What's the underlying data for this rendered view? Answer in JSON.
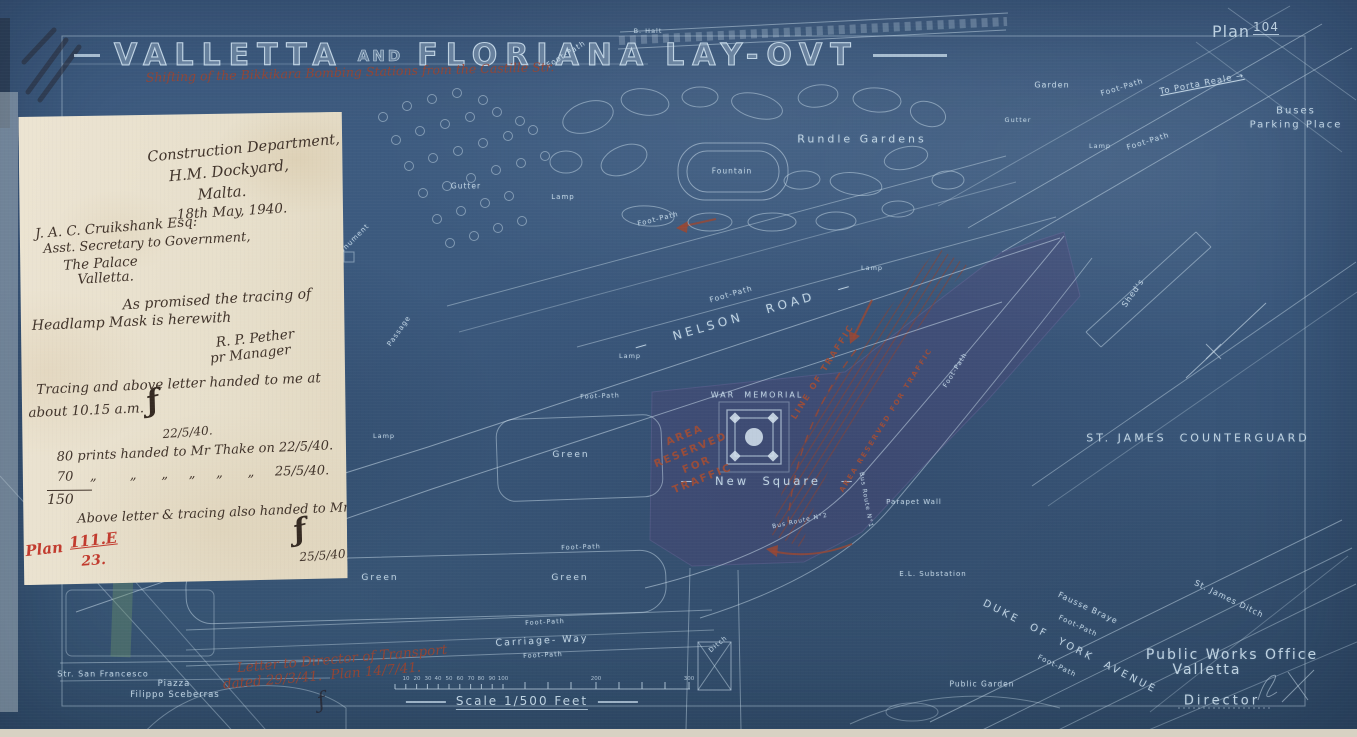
{
  "title": {
    "w1": "VALLETTA",
    "and": "AND",
    "w2": "FLORIANA",
    "w3": "LAY-OVT"
  },
  "plan_ref": {
    "prefix": "Plan",
    "number": "104"
  },
  "scale": {
    "label": "Scale 1/500 Feet",
    "ticks": [
      {
        "t": "10",
        "x": 406
      },
      {
        "t": "20",
        "x": 417
      },
      {
        "t": "30",
        "x": 428
      },
      {
        "t": "40",
        "x": 438
      },
      {
        "t": "50",
        "x": 449
      },
      {
        "t": "60",
        "x": 460
      },
      {
        "t": "70",
        "x": 471
      },
      {
        "t": "80",
        "x": 481
      },
      {
        "t": "90",
        "x": 492
      },
      {
        "t": "100",
        "x": 503
      },
      {
        "t": "200",
        "x": 596
      },
      {
        "t": "300",
        "x": 689
      }
    ]
  },
  "colors": {
    "blueprint": "#3b597d",
    "line": "#c6d9e7",
    "red_note": "#9c432e",
    "paper": "#e7dfcb",
    "ink": "#40332a",
    "red_ink": "#c23b2e"
  },
  "letter": {
    "lines": [
      {
        "t": "Construction Department,",
        "x": 225,
        "y": 36,
        "r": -5,
        "s": 14.5,
        "a": "c"
      },
      {
        "t": "H.M. Dockyard,",
        "x": 210,
        "y": 58,
        "r": -5,
        "s": 15,
        "a": "c"
      },
      {
        "t": "Malta.",
        "x": 203,
        "y": 80,
        "r": -4,
        "s": 15,
        "a": "c"
      },
      {
        "t": "18th May, 1940.",
        "x": 213,
        "y": 99,
        "r": -3,
        "s": 13.5,
        "a": "c"
      },
      {
        "t": "J. A. C. Cruikshank Esq:",
        "x": 16,
        "y": 112,
        "r": -4,
        "s": 13.5
      },
      {
        "t": "Asst. Secretary to Government,",
        "x": 24,
        "y": 128,
        "r": -3,
        "s": 13
      },
      {
        "t": "The Palace",
        "x": 44,
        "y": 144,
        "r": -3,
        "s": 13.5
      },
      {
        "t": "Valletta.",
        "x": 58,
        "y": 158,
        "r": -3,
        "s": 13.5
      },
      {
        "t": "As promised the tracing of",
        "x": 103,
        "y": 184,
        "r": -3,
        "s": 14
      },
      {
        "t": "Headlamp Mask is herewith",
        "x": 12,
        "y": 204,
        "r": -2,
        "s": 14
      },
      {
        "t": "R. P. Pether",
        "x": 196,
        "y": 222,
        "r": -6,
        "s": 13.5
      },
      {
        "t": "pr Manager",
        "x": 190,
        "y": 238,
        "r": -6,
        "s": 13.5
      },
      {
        "t": "Tracing and above letter handed to me at",
        "x": 16,
        "y": 268,
        "r": -2,
        "s": 13.5
      },
      {
        "t": "about 10.15 a.m.",
        "x": 8,
        "y": 291,
        "r": -2,
        "s": 13.5
      },
      {
        "t": "ƒ",
        "x": 126,
        "y": 272,
        "r": -12,
        "s": 30,
        "cls": "mono"
      },
      {
        "t": "22/5/40.",
        "x": 142,
        "y": 314,
        "r": -4,
        "s": 12
      },
      {
        "t": "80 prints handed to Mr Thake on 22/5/40.",
        "x": 36,
        "y": 336,
        "r": -2,
        "s": 13
      },
      {
        "t": "70    „        „      „     „     „      „     25/5/40.",
        "x": 36,
        "y": 356,
        "r": -1,
        "s": 13
      },
      {
        "t": "150",
        "x": 26,
        "y": 376,
        "r": 0,
        "s": 14,
        "cls": "sum"
      },
      {
        "t": "Above letter & tracing also handed to Mr Thake",
        "x": 56,
        "y": 398,
        "r": -2,
        "s": 13
      },
      {
        "t": "ƒ",
        "x": 272,
        "y": 402,
        "r": -12,
        "s": 30,
        "cls": "mono"
      },
      {
        "t": "25/5/40.",
        "x": 278,
        "y": 438,
        "r": -4,
        "s": 12
      },
      {
        "t": "Plan",
        "x": 4,
        "y": 428,
        "r": -6,
        "s": 15,
        "cls": "redink"
      },
      {
        "t": "111.E",
        "x": 48,
        "y": 420,
        "r": -6,
        "s": 15,
        "cls": "redink",
        "u": true
      },
      {
        "t": "23.",
        "x": 60,
        "y": 440,
        "r": -4,
        "s": 14,
        "cls": "redink"
      }
    ]
  },
  "map_labels": [
    {
      "t": "Foot-Path",
      "x": 566,
      "y": 54,
      "r": -32,
      "s": 7.5
    },
    {
      "t": "B. Halt",
      "x": 648,
      "y": 31,
      "r": 0,
      "s": 6.5
    },
    {
      "t": "Foot-Path",
      "x": 1122,
      "y": 87,
      "r": -17,
      "s": 7.5
    },
    {
      "t": "Foot-Path",
      "x": 1148,
      "y": 141,
      "r": -17,
      "s": 7.5
    },
    {
      "t": "Garden",
      "x": 1052,
      "y": 85,
      "r": 0,
      "s": 8
    },
    {
      "t": "To Porta Reale →",
      "x": 1202,
      "y": 84,
      "r": -11,
      "s": 8.5,
      "u": true
    },
    {
      "t": "Buses",
      "x": 1296,
      "y": 111,
      "r": 0,
      "s": 10,
      "ls": 2
    },
    {
      "t": "Parking Place",
      "x": 1296,
      "y": 125,
      "r": 0,
      "s": 10,
      "ls": 2
    },
    {
      "t": "Rundle Gardens",
      "x": 862,
      "y": 139,
      "r": 0,
      "s": 11,
      "ls": 3
    },
    {
      "t": "Fountain",
      "x": 732,
      "y": 171,
      "r": 0,
      "s": 7.5
    },
    {
      "t": "Gutter",
      "x": 466,
      "y": 186,
      "r": 0,
      "s": 7.5
    },
    {
      "t": "Gutter",
      "x": 1018,
      "y": 120,
      "r": 0,
      "s": 6.5
    },
    {
      "t": "Lamp",
      "x": 563,
      "y": 197,
      "r": 0,
      "s": 7
    },
    {
      "t": "Lamp",
      "x": 1100,
      "y": 146,
      "r": 0,
      "s": 6.5
    },
    {
      "t": "Monument",
      "x": 352,
      "y": 241,
      "r": -45,
      "s": 7
    },
    {
      "t": "Passage",
      "x": 399,
      "y": 331,
      "r": -55,
      "s": 7
    },
    {
      "t": "Foot-Path",
      "x": 658,
      "y": 219,
      "r": -14,
      "s": 7
    },
    {
      "t": "Foot-Path",
      "x": 731,
      "y": 294,
      "r": -16,
      "s": 7.5
    },
    {
      "t": "—   NELSON   ROAD   —",
      "x": 744,
      "y": 316,
      "r": -16,
      "s": 12,
      "ls": 4
    },
    {
      "t": "Lamp",
      "x": 872,
      "y": 268,
      "r": 0,
      "s": 6.5
    },
    {
      "t": "Lamp",
      "x": 630,
      "y": 356,
      "r": 0,
      "s": 6.5
    },
    {
      "t": "Lamp",
      "x": 384,
      "y": 436,
      "r": 0,
      "s": 6.5
    },
    {
      "t": "Green",
      "x": 571,
      "y": 455,
      "r": 0,
      "s": 9,
      "ls": 2
    },
    {
      "t": "WAR  MEMORIAL",
      "x": 757,
      "y": 395,
      "r": 0,
      "s": 8,
      "ls": 2
    },
    {
      "t": "—   New  Square   —",
      "x": 768,
      "y": 481,
      "r": 0,
      "s": 11.5,
      "ls": 3
    },
    {
      "t": "Bus Route N°2",
      "x": 800,
      "y": 521,
      "r": -12,
      "s": 6
    },
    {
      "t": "Bus Route N°1",
      "x": 866,
      "y": 500,
      "r": 80,
      "s": 6
    },
    {
      "t": "Parapet Wall",
      "x": 914,
      "y": 502,
      "r": 0,
      "s": 7
    },
    {
      "t": "E.L. Substation",
      "x": 933,
      "y": 574,
      "r": 0,
      "s": 7
    },
    {
      "t": "Shed's",
      "x": 1133,
      "y": 293,
      "r": -55,
      "s": 8
    },
    {
      "t": "ST. JAMES  COUNTERGUARD",
      "x": 1198,
      "y": 438,
      "r": 0,
      "s": 11,
      "ls": 3
    },
    {
      "t": "St. James Ditch",
      "x": 1229,
      "y": 599,
      "r": 26,
      "s": 8
    },
    {
      "t": "Fausse Braye",
      "x": 1088,
      "y": 608,
      "r": 25,
      "s": 8
    },
    {
      "t": "Foot-Path",
      "x": 1078,
      "y": 626,
      "r": 25,
      "s": 7
    },
    {
      "t": "DUKE  OF  YORK  AVENUE",
      "x": 1070,
      "y": 647,
      "r": 27,
      "s": 10,
      "ls": 3
    },
    {
      "t": "Foot-Path",
      "x": 1057,
      "y": 666,
      "r": 26,
      "s": 7
    },
    {
      "t": "Public Works Office",
      "x": 1232,
      "y": 655,
      "r": 0,
      "s": 14,
      "ls": 2
    },
    {
      "t": "Valletta",
      "x": 1207,
      "y": 670,
      "r": 0,
      "s": 14,
      "ls": 2
    },
    {
      "t": "Director",
      "x": 1222,
      "y": 701,
      "r": 0,
      "s": 13,
      "ls": 3
    },
    {
      "t": "Public Garden",
      "x": 982,
      "y": 684,
      "r": 0,
      "s": 7.5
    },
    {
      "t": "Str. San Francesco",
      "x": 103,
      "y": 674,
      "r": 0,
      "s": 8
    },
    {
      "t": "Piazza",
      "x": 174,
      "y": 684,
      "r": 0,
      "s": 8.5
    },
    {
      "t": "Filippo Sceberras",
      "x": 175,
      "y": 695,
      "r": 0,
      "s": 8.5
    },
    {
      "t": "Green",
      "x": 380,
      "y": 578,
      "r": 0,
      "s": 9,
      "ls": 2
    },
    {
      "t": "Green",
      "x": 570,
      "y": 578,
      "r": 0,
      "s": 9,
      "ls": 2
    },
    {
      "t": "Foot-Path",
      "x": 581,
      "y": 547,
      "r": -2,
      "s": 6.5
    },
    {
      "t": "Foot-Path",
      "x": 545,
      "y": 622,
      "r": -3,
      "s": 6.5
    },
    {
      "t": "Carriage- Way",
      "x": 542,
      "y": 641,
      "r": -3,
      "s": 9.5,
      "ls": 2
    },
    {
      "t": "Foot-Path",
      "x": 543,
      "y": 655,
      "r": -3,
      "s": 6.5
    },
    {
      "t": "Foot-Path",
      "x": 600,
      "y": 396,
      "r": -2,
      "s": 6.5
    },
    {
      "t": "Foot-Path",
      "x": 955,
      "y": 370,
      "r": -58,
      "s": 6.5
    },
    {
      "t": "Ditch",
      "x": 718,
      "y": 644,
      "r": -40,
      "s": 6.5
    },
    {
      "t": "ƒ",
      "x": 322,
      "y": 701,
      "r": -15,
      "s": 22,
      "c": "dark"
    }
  ],
  "red_labels": [
    {
      "t": "AREA\nRESERVED\nFOR\nTRAFFIC",
      "x": 694,
      "y": 458,
      "r": -22,
      "s": 10.5,
      "lh": 1.5
    },
    {
      "t": "LINE OF TRAFFIC",
      "x": 823,
      "y": 372,
      "r": -58,
      "s": 8.5
    },
    {
      "t": "AREA RESERVED FOR TRAFFIC",
      "x": 886,
      "y": 420,
      "r": -58,
      "s": 7
    },
    {
      "t": "Letter to Director of Transport",
      "x": 342,
      "y": 659,
      "r": -5,
      "s": 13.5,
      "h": 1
    },
    {
      "t": "dated 29/3/41.  Plan 14/7/41.",
      "x": 322,
      "y": 676,
      "r": -5,
      "s": 13.5,
      "h": 1
    },
    {
      "t": "Shifting of the Bikkikara Bombing Stations from the Castille Str.",
      "x": 350,
      "y": 72,
      "r": -1.5,
      "s": 12.5,
      "h": 1
    }
  ]
}
